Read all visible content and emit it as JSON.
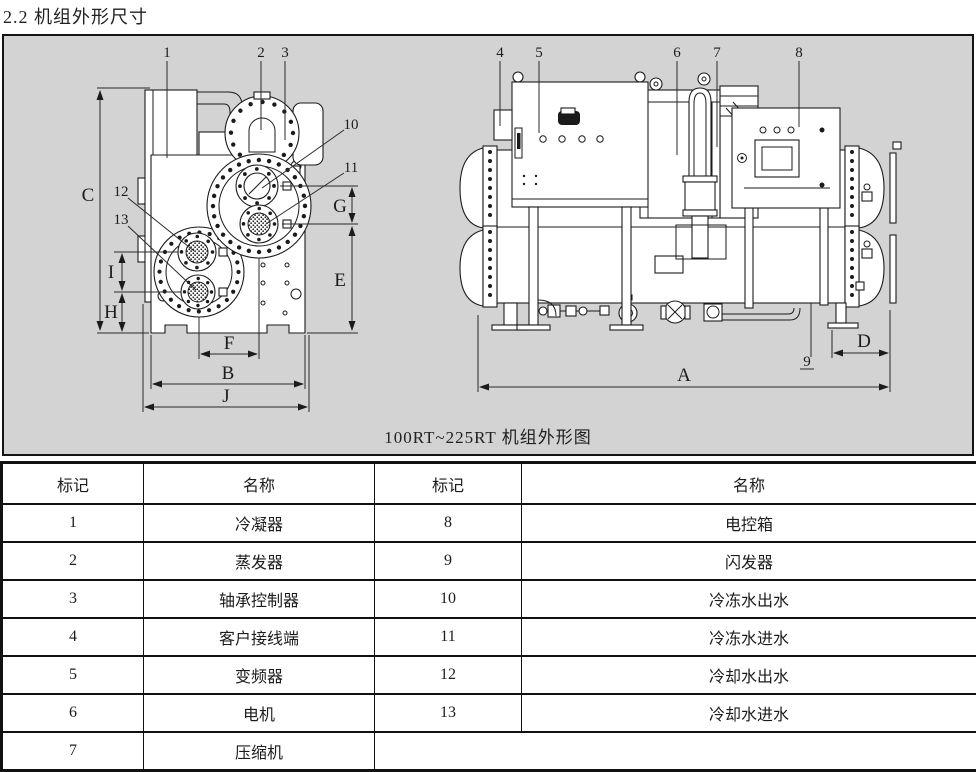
{
  "page": {
    "title": "2.2 机组外形尺寸"
  },
  "drawing": {
    "caption": "100RT~225RT 机组外形图",
    "colors": {
      "background": "#d3d3d4",
      "line": "#1b1b1b"
    },
    "dims": {
      "a": "A",
      "b": "B",
      "c": "C",
      "d": "D",
      "e": "E",
      "f": "F",
      "g": "G",
      "h": "H",
      "i": "I",
      "j": "J"
    },
    "callouts": {
      "n1": "1",
      "n2": "2",
      "n3": "3",
      "n4": "4",
      "n5": "5",
      "n6": "6",
      "n7": "7",
      "n8": "8",
      "n9": "9",
      "n10": "10",
      "n11": "11",
      "n12": "12",
      "n13": "13"
    }
  },
  "table": {
    "headers": [
      "标记",
      "名称",
      "标记",
      "名称"
    ],
    "rows": [
      [
        "1",
        "冷凝器",
        "8",
        "电控箱"
      ],
      [
        "2",
        "蒸发器",
        "9",
        "闪发器"
      ],
      [
        "3",
        "轴承控制器",
        "10",
        "冷冻水出水"
      ],
      [
        "4",
        "客户接线端",
        "11",
        "冷冻水进水"
      ],
      [
        "5",
        "变频器",
        "12",
        "冷却水出水"
      ],
      [
        "6",
        "电机",
        "13",
        "冷却水进水"
      ],
      [
        "7",
        "压缩机",
        ""
      ]
    ]
  }
}
